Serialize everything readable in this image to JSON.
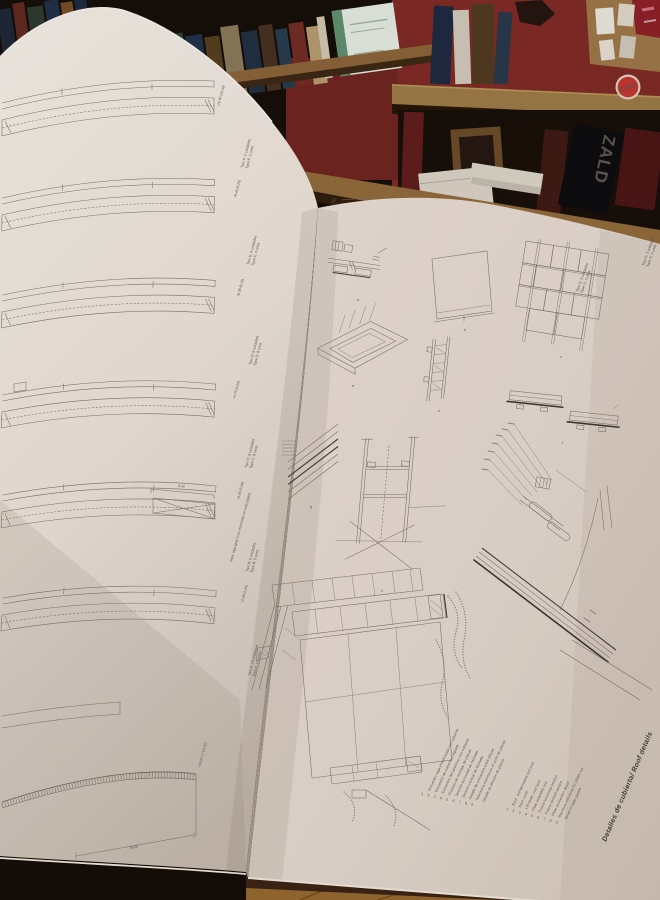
{
  "palette": {
    "red_wall": "#7e2a24",
    "red_wall_dark": "#6e241f",
    "shelf_wood": "#8a6437",
    "shelf_wood_2": "#9a7a45",
    "board_wood": "#8f6a3a",
    "floor_wood": "#94682f",
    "page_left": "#efe8e0",
    "page_right": "#e3d8cf",
    "sticker_red": "#c33631",
    "print_line": "#7d736a",
    "print_text": "#5f574f"
  },
  "scene": {
    "stop_sticker": "STOP",
    "book_spine_text": "ZALD"
  },
  "left_page": {
    "beam_captions": [
      {
        "es": "Tipo F: 2 unidades",
        "en": "Type F: 2 units"
      },
      {
        "es": "Tipo E: 4 unidades",
        "en": "Type E: 4 units"
      },
      {
        "es": "Tipo D: 8 unidades",
        "en": "Type D: 8 units"
      },
      {
        "es": "Tipo C: 8 unidades",
        "en": "Type C: 8 units"
      },
      {
        "es": "Tipo B: 5 unidades",
        "en": "Type B: 5 units"
      },
      {
        "es": "Tipo A: 10 unidades",
        "en": "Type A: 10 units"
      }
    ],
    "elevation_labels": [
      "+10.60 (10.40)",
      "+9.45 (9.25)",
      "+8.30 (8.10)",
      "+4.70 (4.55)",
      "+3.55 (3.40)",
      "+2.40 (2.25)",
      "+15.80 (+16.40)"
    ],
    "dim_labels": [
      "8.50",
      "30.00"
    ],
    "note": "Nota: viga igual a las mostradas en esta página"
  },
  "right_page": {
    "page_number": "60",
    "title": "Detalles de cubierta/ Roof details",
    "plate_captions": [
      {
        "es": "Tipo G: 3 unidades",
        "en": "Type G: 3 units"
      },
      {
        "es": "Tipo H: 2 unidades",
        "en": "Type H: 2 units"
      }
    ],
    "figure_letters": [
      "a",
      "b",
      "c",
      "d",
      "e",
      "f",
      "g",
      "h"
    ],
    "legend_es": {
      "numbers": "1 2 3 4 5 6 7 8 9",
      "items": [
        "Encuentro viga prefabricada con cubierta",
        "Encuentro de cubierta y vigueta",
        "Encuentro del ascensor con cubierta",
        "Proceso de montaje de placas",
        "Sección horizontal de fachada",
        "Sección vertical de fachada",
        "Detalle de encuentro entre placas",
        "Tolerancia máxima en el corte de placas",
        "Detalle de división de placas"
      ]
    },
    "legend_en": {
      "numbers": "1 2 3 4 5 6 7 8 9",
      "items": [
        "Roof : prefabricated roof joist",
        "Roof / joist",
        "Lift shaft : roof joist",
        "Plate assembly row",
        "Fascia horizontal section",
        "Fascia vertical section",
        "Plate connection detail",
        "Maximum tolerance for plates cut",
        "Detail of slate panels"
      ]
    }
  }
}
